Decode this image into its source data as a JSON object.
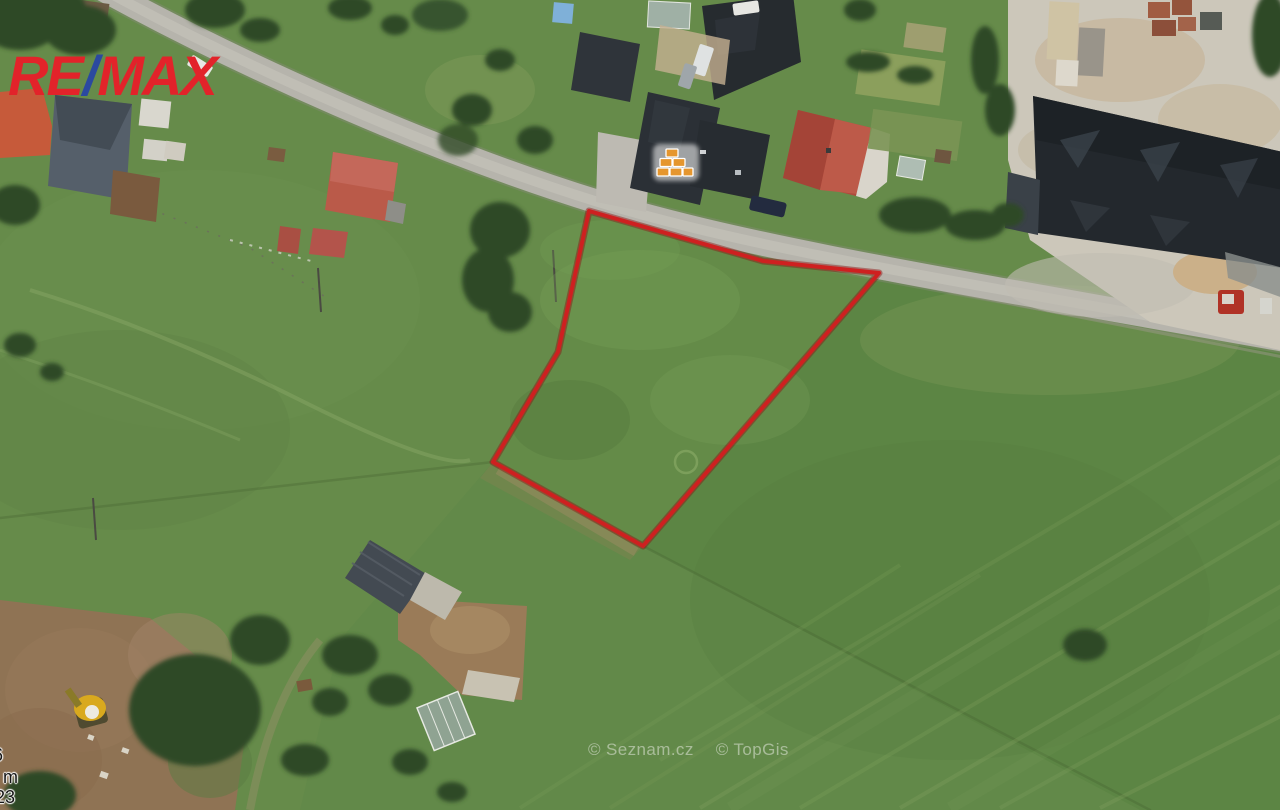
{
  "branding": {
    "re": "RE",
    "slash": "/",
    "max": "MAX",
    "red": "#E2232A",
    "blue": "#2B49A0"
  },
  "parcel": {
    "points": "589,211 763,261 879,273 643,546 493,462 558,352",
    "outline_color": "#CE2020",
    "outline_glow_color": "#8E1212"
  },
  "marker": {
    "type": "bricks",
    "brick_color": "#E5962E"
  },
  "attribution": {
    "seznam": "© Seznam.cz",
    "topgis": "© TopGis"
  },
  "scale_fragments": {
    "top": "6",
    "middle": "m",
    "bottom": "23"
  },
  "palette": {
    "field_green": "#63884A",
    "parcel_green": "#618C48",
    "road_gray": "#B6B4AC",
    "paved_yard": "#CCC7BA",
    "dirt_brown": "#8F7354",
    "dark_roof": "#2B3036",
    "red_roof": "#AF4A3C",
    "tree_green": "#2F4A28"
  }
}
